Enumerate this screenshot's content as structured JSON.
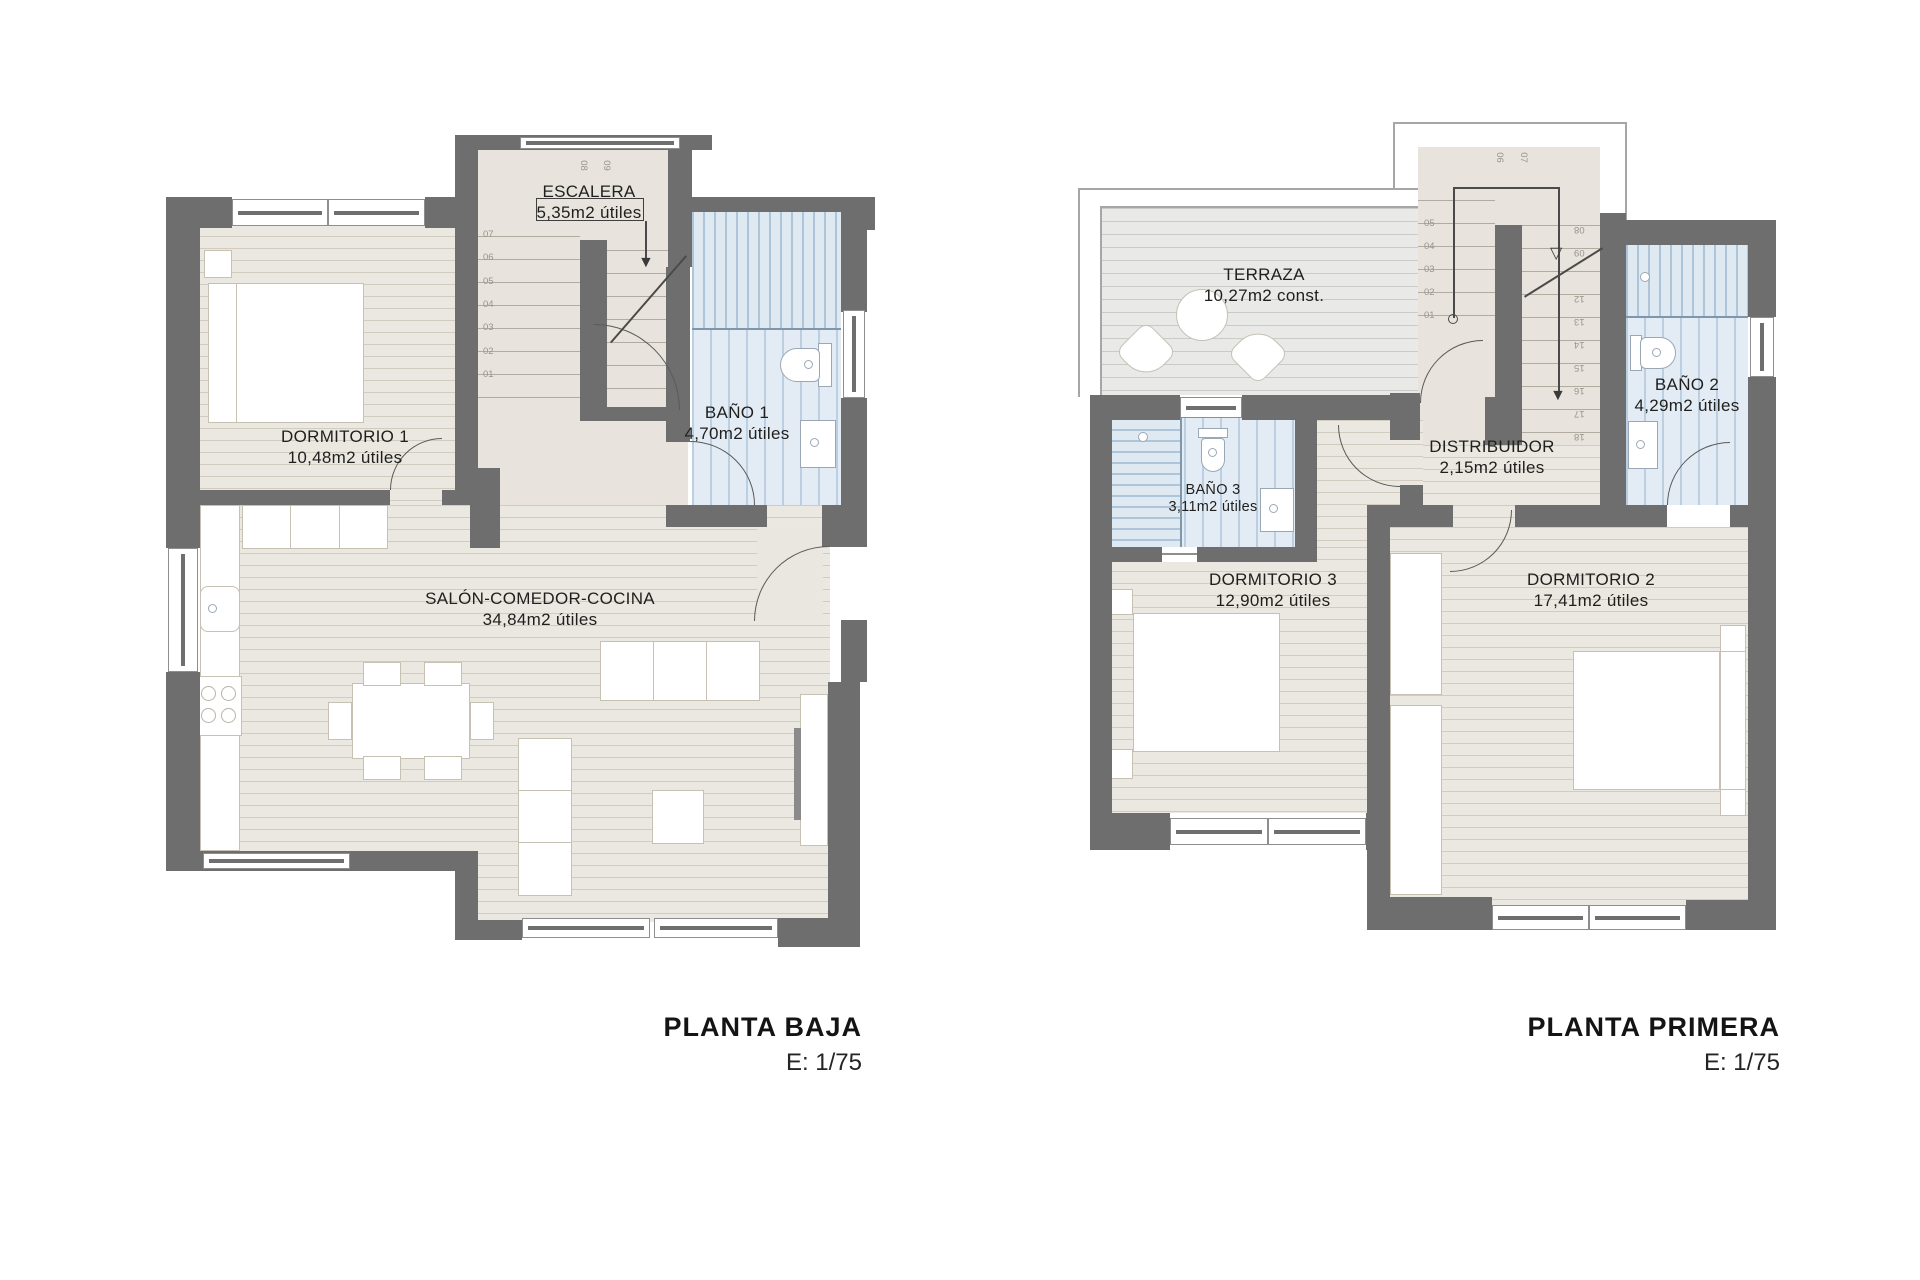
{
  "sheet": {
    "kind": "architectural floor plans"
  },
  "icons": {
    "arrow_solid": "▼",
    "arrow_open": "▽"
  },
  "plans": [
    {
      "title": "PLANTA BAJA",
      "scale": "E: 1/75",
      "rooms": {
        "dormitorio1": {
          "name": "DORMITORIO 1",
          "area": "10,48m2 útiles"
        },
        "escalera": {
          "name": "ESCALERA",
          "area": "5,35m2 útiles"
        },
        "bano1": {
          "name": "BAÑO 1",
          "area": "4,70m2 útiles"
        },
        "salon": {
          "name": "SALÓN-COMEDOR-COCINA",
          "area": "34,84m2 útiles"
        }
      },
      "stairs": {
        "up": [
          "01",
          "02",
          "03",
          "04",
          "05",
          "06",
          "07"
        ],
        "top": [
          "08",
          "09"
        ]
      }
    },
    {
      "title": "PLANTA PRIMERA",
      "scale": "E: 1/75",
      "rooms": {
        "terraza": {
          "name": "TERRAZA",
          "area": "10,27m2 const."
        },
        "bano2": {
          "name": "BAÑO 2",
          "area": "4,29m2 útiles"
        },
        "bano3": {
          "name": "BAÑO 3",
          "area": "3,11m2 útiles"
        },
        "distribuidor": {
          "name": "DISTRIBUIDOR",
          "area": "2,15m2 útiles"
        },
        "dormitorio3": {
          "name": "DORMITORIO 3",
          "area": "12,90m2 útiles"
        },
        "dormitorio2": {
          "name": "DORMITORIO 2",
          "area": "17,41m2 útiles"
        }
      },
      "stairs": {
        "up": [
          "01",
          "02",
          "03",
          "04",
          "05"
        ],
        "top": [
          "06",
          "07"
        ],
        "down": [
          "08",
          "09",
          "12",
          "13",
          "14",
          "15",
          "16",
          "17",
          "18"
        ]
      }
    }
  ]
}
